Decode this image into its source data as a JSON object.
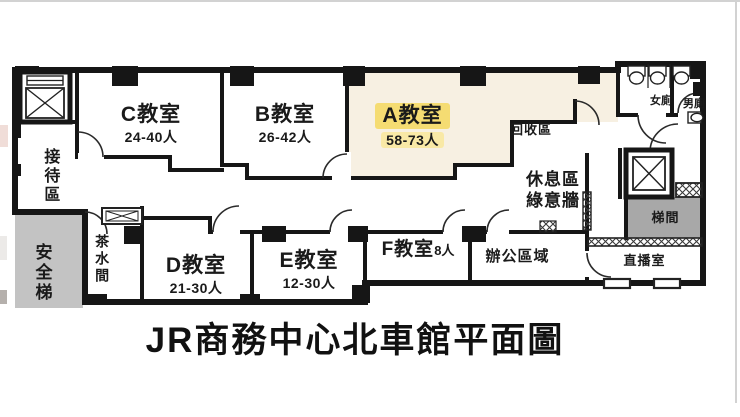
{
  "title": "JR商務中心北車館平面圖",
  "floorplan": {
    "classrooms": {
      "a": {
        "name": "A教室",
        "capacity": "58-73人",
        "highlighted": true
      },
      "b": {
        "name": "B教室",
        "capacity": "26-42人"
      },
      "c": {
        "name": "C教室",
        "capacity": "24-40人"
      },
      "d": {
        "name": "D教室",
        "capacity": "21-30人"
      },
      "e": {
        "name": "E教室",
        "capacity": "12-30人"
      },
      "f": {
        "name": "F教室",
        "capacity": "8人"
      }
    },
    "areas": {
      "reception": "接待區",
      "safety_stair": "安全梯",
      "pantry": "茶水間",
      "recycling": "回收區",
      "lounge_line1": "休息區",
      "lounge_line2": "綠意牆",
      "office": "辦公區域",
      "broadcast": "直播室",
      "stairwell": "梯間",
      "women_toilet": "女廁",
      "men_toilet": "男廁"
    },
    "colors": {
      "highlight_strong": "#F5DC72",
      "highlight_light": "#F9E9A6",
      "room_a_fill": "#F7F0E2",
      "stair_gray_light": "#C3C3C3",
      "stair_gray_dark": "#A8A8A8",
      "wall": "#161616"
    }
  }
}
